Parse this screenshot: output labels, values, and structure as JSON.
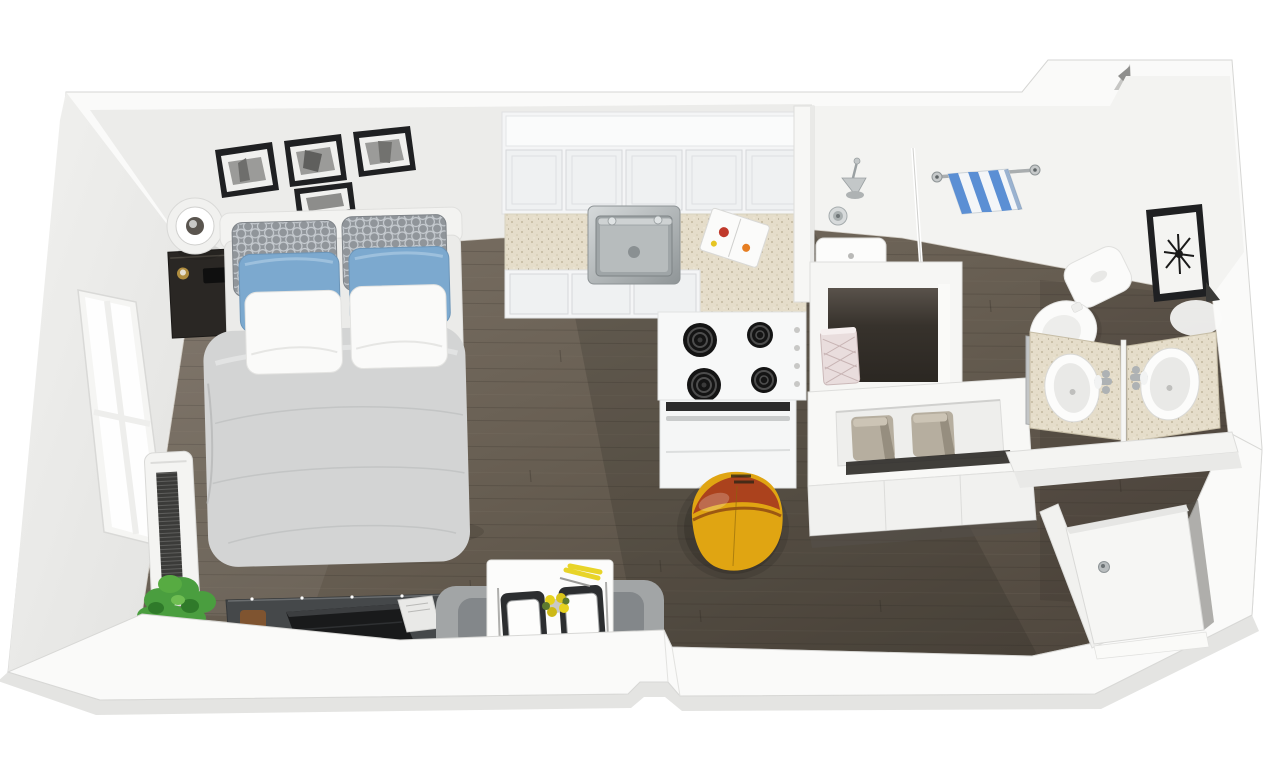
{
  "scene": {
    "type": "3d-floor-plan",
    "subject": "studio apartment dollhouse top-down rendering",
    "text_content": "none",
    "view": "tilted top-down 3D"
  },
  "palette": {
    "background": "#ffffff",
    "wall_white": "#fafaf9",
    "wall_face": "#ececea",
    "wall_shadow": "#e4e4e2",
    "floor_wood": "#6b6154",
    "floor_dark": "#4a423a",
    "counter_speckle": "#e9e2d0",
    "vanity_speckle": "#ded7c3",
    "cabinet_white": "#f4f5f6",
    "stainless": "#b9bdbf",
    "pillow_blue": "#7ca9cf",
    "pillow_gray": "#90959a",
    "blanket_gray": "#d3d4d4",
    "towel_blue": "#5b8fd4",
    "plant_green": "#4a9e3f",
    "chair_yellow": "#e0a512",
    "chair_red": "#a63a1e",
    "desk_dark": "#45484a",
    "laptop_black": "#191a1b",
    "dining_chair_gray": "#a2a5a6",
    "placemat_dark": "#2c2e30",
    "stool_tan": "#b6ae9f",
    "frame_black": "#1f2022",
    "door_white": "#f6f6f4",
    "chrome": "#aeb2b4"
  },
  "rooms": [
    {
      "id": "living-sleeping",
      "label": "combined living and sleeping area"
    },
    {
      "id": "kitchen",
      "label": "open L-shaped kitchen"
    },
    {
      "id": "bathroom",
      "label": "bathroom with shower and double vanity"
    },
    {
      "id": "entry",
      "label": "entry nook with door"
    }
  ],
  "furniture": [
    {
      "id": "bed",
      "label": "double bed with gray duvet, white, blue and patterned gray pillows"
    },
    {
      "id": "gallery-frames",
      "label": "four black framed black-and-white pictures above bed",
      "count": 4
    },
    {
      "id": "nightstand",
      "label": "dark nightstand with white drum table lamp"
    },
    {
      "id": "window",
      "label": "four-pane window on left wall"
    },
    {
      "id": "ptac-unit",
      "label": "white vertical heater / AC unit with dark grille"
    },
    {
      "id": "potted-plant",
      "label": "green plant in white pot"
    },
    {
      "id": "desk",
      "label": "dark desk with black laptop and papers"
    },
    {
      "id": "dining-table",
      "label": "white dining table, two placemats, plates, yellow flowers"
    },
    {
      "id": "dining-chairs",
      "label": "two gray dining chairs",
      "count": 2
    },
    {
      "id": "kitchen-cabinets",
      "label": "white upper and base cabinets with speckled countertop"
    },
    {
      "id": "kitchen-sink",
      "label": "stainless steel sink with faucet"
    },
    {
      "id": "range",
      "label": "white range with four black coil burners and oven"
    },
    {
      "id": "cookbook",
      "label": "open cookbook on counter corner"
    },
    {
      "id": "egg-chair",
      "label": "glossy yellow and red egg pod chair"
    },
    {
      "id": "breakfast-bar",
      "label": "white breakfast bar with two tan stools",
      "count_stools": 2
    },
    {
      "id": "closet",
      "label": "closet with patterned storage basket"
    },
    {
      "id": "shower",
      "label": "shower with chrome head, ceiling light and glass divider"
    },
    {
      "id": "towel",
      "label": "blue and white striped towel on chrome bar"
    },
    {
      "id": "toilet",
      "label": "white toilet"
    },
    {
      "id": "vanity",
      "label": "double vanity, speckled counter, two white sinks, chrome faucets"
    },
    {
      "id": "bathroom-art",
      "label": "black framed artwork on bathroom wall"
    },
    {
      "id": "entry-door",
      "label": "white entry door ajar with chrome knob"
    }
  ]
}
